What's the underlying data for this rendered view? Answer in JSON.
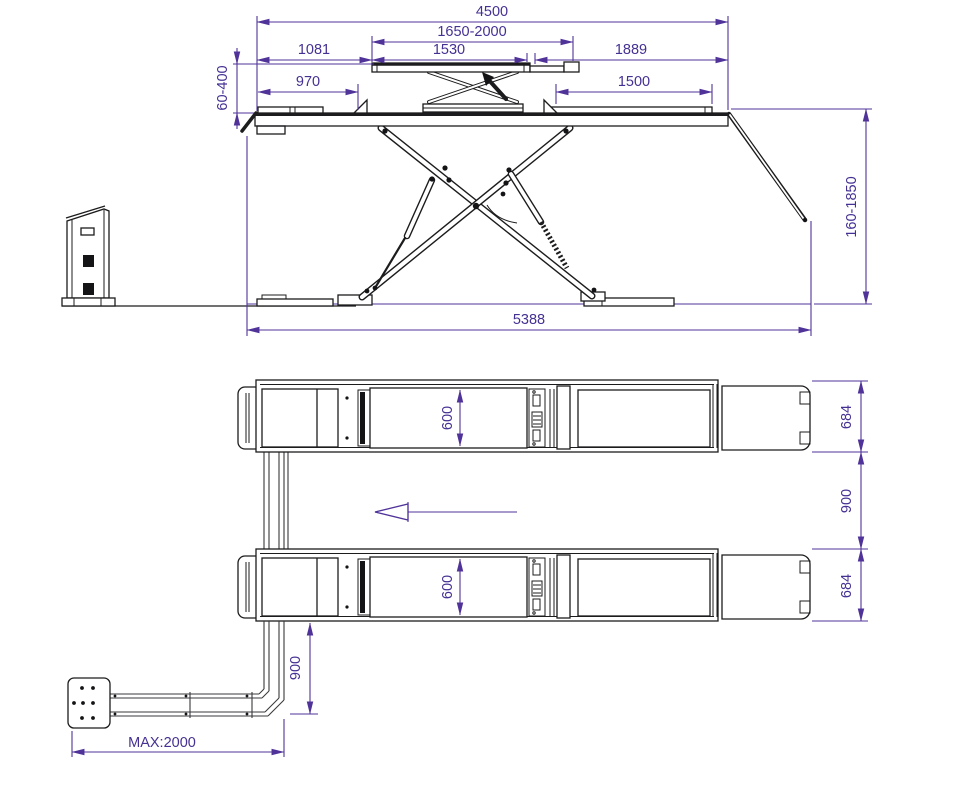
{
  "drawing": {
    "subject": "scissor-car-lift-technical-drawing",
    "colors": {
      "line": "#1c1c1e",
      "dimension": "#503399",
      "background": "#ffffff"
    },
    "side_view": {
      "dims": {
        "overall_length_top": "4500",
        "jack_platform_range": "1650-2000",
        "offset_left": "1081",
        "jack_platform_fixed": "1530",
        "offset_right": "1889",
        "jack_lift_height": "60-400",
        "flat_left": "970",
        "flat_right": "1500",
        "lift_height_range": "160-1850",
        "overall_length_floor": "5388"
      }
    },
    "plan_view": {
      "dims": {
        "runway_cutout_top": "600",
        "runway_cutout_bottom": "600",
        "runway_width_top": "684",
        "runway_width_bottom": "684",
        "runway_gap": "900",
        "console_offset": "900",
        "cable_run_max": "MAX:2000"
      }
    }
  }
}
